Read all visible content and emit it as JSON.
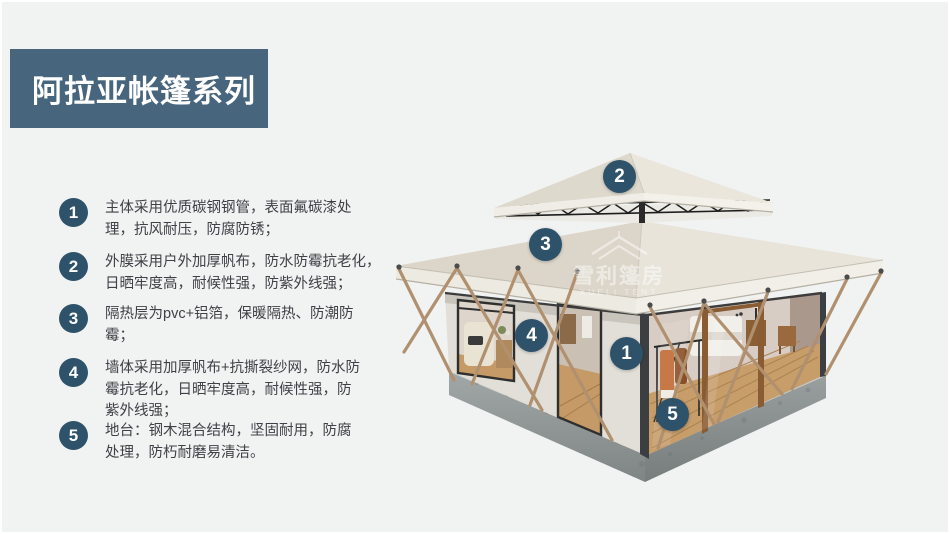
{
  "title": {
    "text": "阿拉亚帐篷系列"
  },
  "features": [
    {
      "num": "1",
      "lines": [
        "主体采用优质碳钢钢管，表面氟碳漆处",
        "理，抗风耐压，防腐防锈；"
      ]
    },
    {
      "num": "2",
      "lines": [
        "外膜采用户外加厚帆布，防水防霉抗老化，",
        "日晒牢度高，耐候性强，防紫外线强；"
      ]
    },
    {
      "num": "3",
      "lines": [
        "隔热层为pvc+铝箔，保暖隔热、防潮防",
        "霉；"
      ]
    },
    {
      "num": "4",
      "lines": [
        "墙体采用加厚帆布+抗撕裂纱网，防水防",
        "霉抗老化，日晒牢度高，耐候性强，防",
        "紫外线强；"
      ]
    },
    {
      "num": "5",
      "lines": [
        "地台：钢木混合结构，坚固耐用，防腐",
        "处理，防朽耐磨易清洁。"
      ]
    }
  ],
  "markers": [
    "1",
    "2",
    "3",
    "4",
    "5"
  ],
  "watermark": {
    "cn": "雪利篷房",
    "en": "XUELI TENT"
  },
  "colors": {
    "page-bg": "#f1f2f2",
    "title-bg": "#47657c",
    "badge-bg": "#2e5269",
    "text": "#3e4246",
    "roof": "#e8e4da",
    "platform": "#8f9696",
    "pole": "#b0906f"
  }
}
